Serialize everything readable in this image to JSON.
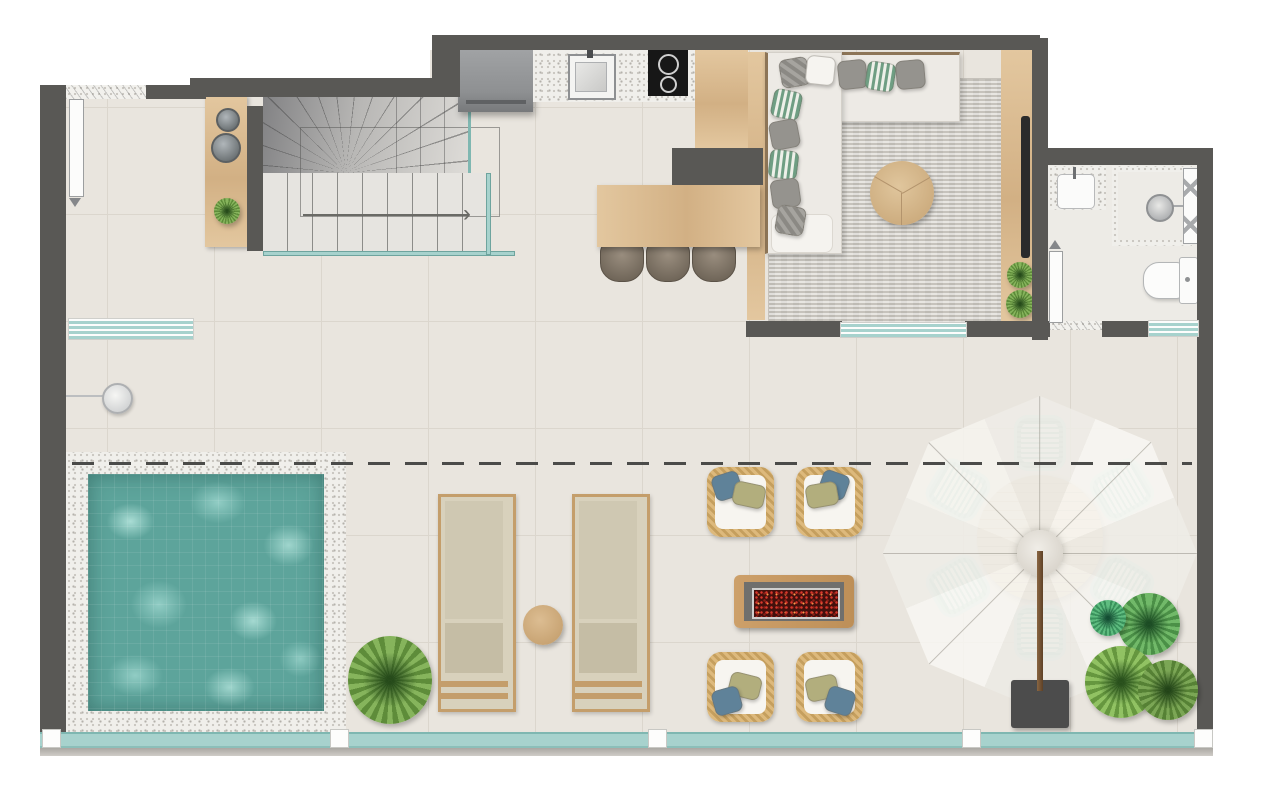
{
  "document": {
    "type": "architectural-floor-plan",
    "view": "top-down-render",
    "visible_text": "none"
  },
  "colors": {
    "wall": "#595855",
    "floor": "#e9e5de",
    "grout": "#dbd6cd",
    "granite": "#f0efeb",
    "woodl": "#e3c79f",
    "woodm": "#d2b084",
    "woodd": "#c49e6b",
    "water": "#5da49b",
    "waterlight": "#9bd3ca",
    "tealglass": "#a7d2cd",
    "tealedge": "#7fb7b1",
    "rug": "#d8d5cf",
    "sofa": "#edeae5",
    "umbrella": "#f5f3ef",
    "mint": "#cfe8e2",
    "wicker": "#d9b577",
    "pillowblue": "#5f8299",
    "pillowolive": "#b2ae7d",
    "ember": "#43100c",
    "emberspark": "#d8372b",
    "plantgreen": "#76a24c",
    "tv": "#2b2b2b"
  },
  "plan": {
    "rooms": [
      "entry",
      "staircase",
      "kitchen",
      "dining",
      "living-room",
      "bathroom",
      "terrace",
      "pool-deck"
    ],
    "furniture": [
      "console-table",
      "refrigerator",
      "kitchen-sink",
      "cooktop",
      "kitchen-island",
      "dining-table",
      "bar-stools",
      "sectional-sofa",
      "coffee-table",
      "area-rug",
      "tv-panel",
      "bathroom-vanity",
      "shower",
      "toilet",
      "glass-bench",
      "outdoor-shower",
      "swimming-pool",
      "sun-loungers",
      "side-table",
      "wicker-armchairs",
      "fire-pit-table",
      "parasol",
      "outdoor-dining-set",
      "plants",
      "glass-railing"
    ]
  }
}
